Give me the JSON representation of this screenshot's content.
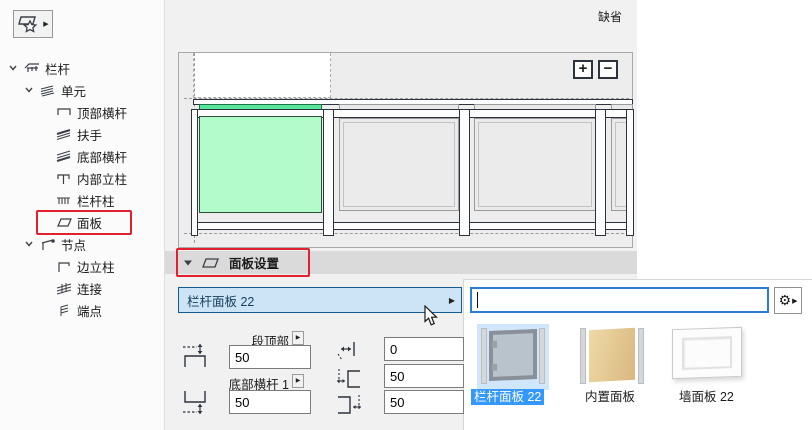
{
  "window": {
    "default_label": "缺省",
    "accent_blue": "#2b7dd4",
    "selection_blue": "#3598fd",
    "annotation_red": "#e3202e",
    "highlight_green": "#b4fbcc"
  },
  "toolbar": {
    "favorites_button_icon": "panel-star-icon",
    "favorites_flyout_arrow": "▶"
  },
  "tree": {
    "items": [
      {
        "label": "栏杆",
        "level": 0,
        "expanded": true,
        "icon": "railing-icon"
      },
      {
        "label": "单元",
        "level": 1,
        "expanded": true,
        "icon": "unit-icon"
      },
      {
        "label": "顶部横杆",
        "level": 2,
        "expanded": false,
        "icon": "top-rail-icon"
      },
      {
        "label": "扶手",
        "level": 2,
        "expanded": false,
        "icon": "handrail-icon"
      },
      {
        "label": "底部横杆",
        "level": 2,
        "expanded": false,
        "icon": "bottom-rail-icon"
      },
      {
        "label": "内部立柱",
        "level": 2,
        "expanded": false,
        "icon": "inner-post-icon"
      },
      {
        "label": "栏杆柱",
        "level": 2,
        "expanded": false,
        "icon": "baluster-icon"
      },
      {
        "label": "面板",
        "level": 2,
        "expanded": false,
        "icon": "panel-icon",
        "highlighted": true
      },
      {
        "label": "节点",
        "level": 1,
        "expanded": true,
        "icon": "node-icon"
      },
      {
        "label": "边立柱",
        "level": 2,
        "expanded": false,
        "icon": "edge-post-icon"
      },
      {
        "label": "连接",
        "level": 2,
        "expanded": false,
        "icon": "connection-icon"
      },
      {
        "label": "端点",
        "level": 2,
        "expanded": false,
        "icon": "endpoint-icon"
      }
    ]
  },
  "preview": {
    "zoom_in_label": "+",
    "zoom_out_label": "−",
    "selected_panel_color": "#b4fbcc"
  },
  "section": {
    "title": "面板设置",
    "collapse_arrow": "▼",
    "icon": "panel-icon"
  },
  "panel_selector": {
    "value": "栏杆面板 22",
    "flyout_arrow": "▶"
  },
  "search": {
    "value": "",
    "placeholder": "",
    "gear_icon": "⚙",
    "gear_arrow": "▶"
  },
  "fields": {
    "top_label": "段顶部",
    "top_value": "50",
    "bottom_label": "底部横杆 1",
    "bottom_value": "50",
    "offset_value": "0",
    "gap_left_value": "50",
    "gap_right_value": "50"
  },
  "gallery": {
    "items": [
      {
        "label": "栏杆面板 22",
        "selected": true,
        "thumb": "glass-panel"
      },
      {
        "label": "内置面板",
        "selected": false,
        "thumb": "wood-panel"
      },
      {
        "label": "墙面板 22",
        "selected": false,
        "thumb": "wall-panel"
      }
    ]
  }
}
